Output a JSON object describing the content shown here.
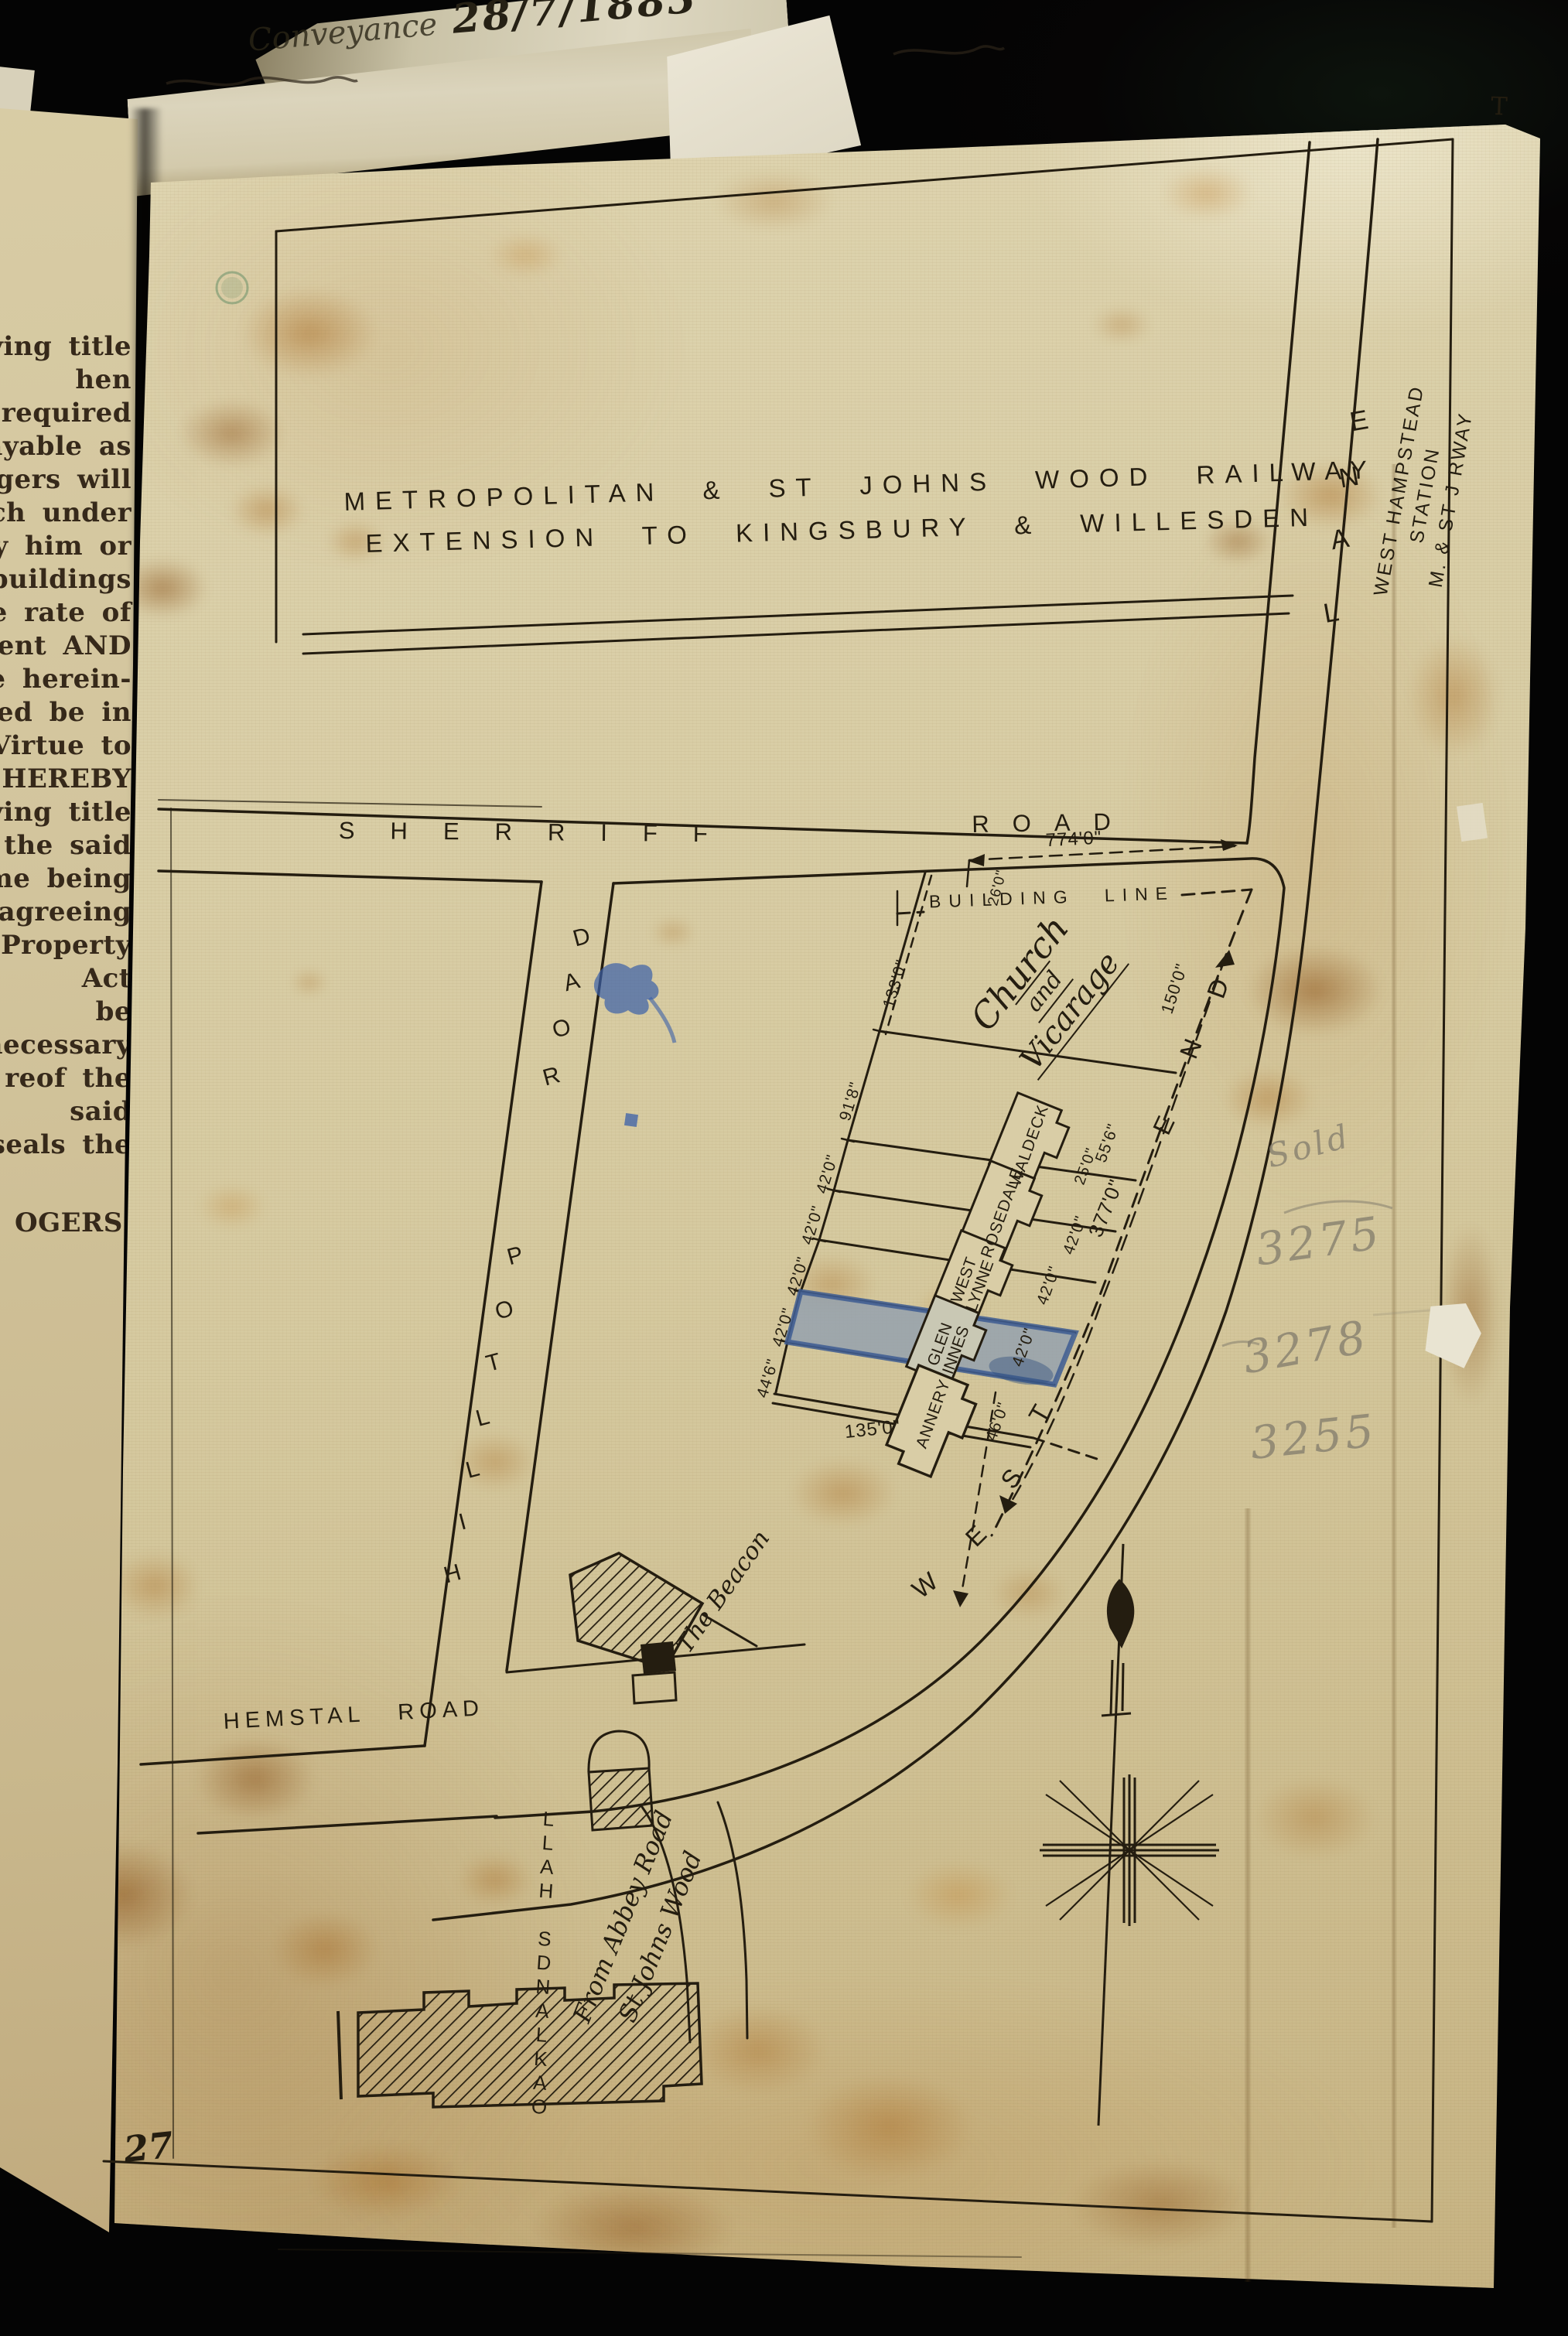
{
  "annotations": {
    "conveyance_label": "Conveyance",
    "date": "28/7/1883",
    "sheet_number": "27",
    "corner_mark": "T",
    "pencil": {
      "sold": "Sold",
      "n1": "3275",
      "n2": "3278",
      "n3": "3255"
    }
  },
  "deed_text": {
    "lines": [
      "leriving title",
      "hen required",
      "payable as",
      "Rogers will",
      "which under",
      "l by him or",
      "d buildings",
      "the rate of",
      "ment AND",
      "ance herein-",
      "rmed be in",
      "nt Virtue to",
      "S HEREBY",
      "eriving title",
      "of the said",
      "time being",
      "of agreeing",
      "Property Act",
      "be necessary",
      "reof the said",
      "nd seals the",
      "OGERS."
    ]
  },
  "map": {
    "railway": {
      "line1": "METROPOLITAN & ST JOHNS WOOD RAILWAY",
      "line2": "EXTENSION TO KINGSBURY & WILLESDEN"
    },
    "roads": {
      "sherriff_1": "SHERRIFF",
      "sherriff_2": "ROAD",
      "hilltop": "HILLTOP ROAD",
      "hemstal": "HEMSTAL ROAD",
      "west": "WEST",
      "end": "END",
      "lane": "LANE",
      "station_1": "WEST HAMPSTEAD",
      "station_2": "STATION",
      "station_3": "M. & ST J RWAY",
      "abbey_1": "From Abbey Road",
      "abbey_2": "St Johns Wood",
      "oaklands": "OAKLANDS HALL"
    },
    "labels": {
      "building_line": "BUILDING LINE",
      "church_1": "Church",
      "church_2": "and",
      "church_3": "Vicаrage",
      "beacon": "The Beacon"
    },
    "houses": [
      "WALDECK",
      "ROSEDALE",
      "WEST LYNNE",
      "GLEN INNES",
      "ANNERY"
    ],
    "measurements": {
      "w133": "133'0\"",
      "w918": "91'8\"",
      "w42": "42'0\"",
      "w446": "44'6\"",
      "f150": "150'0\"",
      "f556": "55'6\"",
      "f25": "25'0\"",
      "f377": "377'0\"",
      "f46": "46'0\"",
      "b135": "135'0\"",
      "r774": "774'0\"",
      "s26": "26'0\""
    },
    "colors": {
      "ink": "#241d10",
      "plot_highlight_fill": "#93a0ae",
      "plot_highlight_edge": "#3d5c92",
      "pencil": "#8b8471",
      "paper": "#d8cda6"
    }
  }
}
